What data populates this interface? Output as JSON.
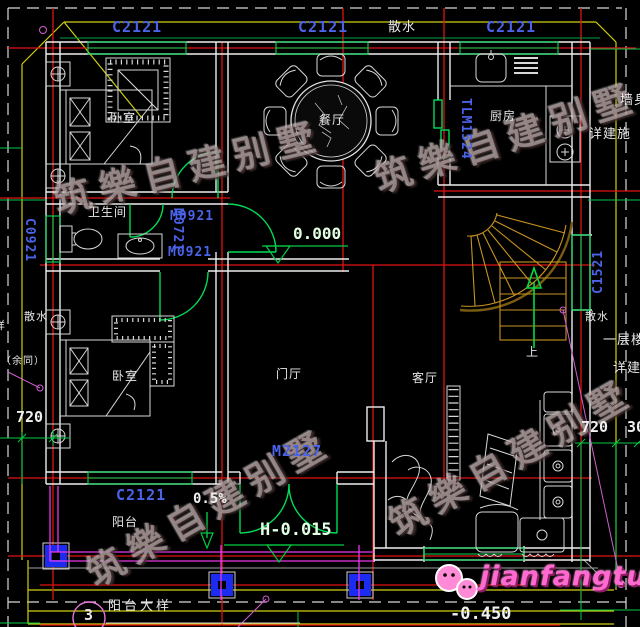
{
  "watermark": "筑樂自建别墅",
  "logo_text": "jianfangtuzhi",
  "labels": {
    "c2121_top_left": "C2121",
    "c2121_top_mid": "C2121",
    "c2121_top_right": "C2121",
    "c0921_left": "C0921",
    "c1521_right": "C1521",
    "c2121_bottom": "C2121",
    "m0921_upper": "M0921",
    "m0721_vertical": "M0721",
    "m0921_lower": "M0921",
    "m2127_entry": "M2127",
    "tlm1524_kitchen": "TLM1524"
  },
  "rooms": {
    "bedroom_top": "卧室",
    "dining": "餐厅",
    "kitchen": "厨房",
    "bathroom": "卫生间",
    "bedroom_bottom": "卧室",
    "foyer": "门厅",
    "living": "客厅",
    "balcony": "阳台"
  },
  "annotations": {
    "sanshui_top": "散水",
    "sanshui_left": "散水",
    "sanshui_right": "散水",
    "yu_tong": "（余同）",
    "yang_partial": "样",
    "qiang_shen": "墙身",
    "xiang_jianshi_paren": "详建施（全",
    "yiceng_louti": "一层楼梯",
    "xiang_jianshi": "详建施",
    "up": "上",
    "slope": "0.5%"
  },
  "levels": {
    "floor": "0.000",
    "entry": "H-0.015",
    "ground": "-0.450"
  },
  "dimensions": {
    "left_720": "720",
    "right_720": "720",
    "right_300": "300"
  },
  "detail_callout": {
    "number": "3",
    "label": "阳台大样"
  },
  "colors": {
    "axis_red": "#e21212",
    "window_green": "#00d855",
    "label_blue": "#4a63e8",
    "roof_yellow": "#cfcf10",
    "railing_magenta": "#e838e8",
    "column_blue": "#1b2bf0",
    "stair_gold": "#c89420",
    "logo_pink": "#ff6ad0"
  }
}
